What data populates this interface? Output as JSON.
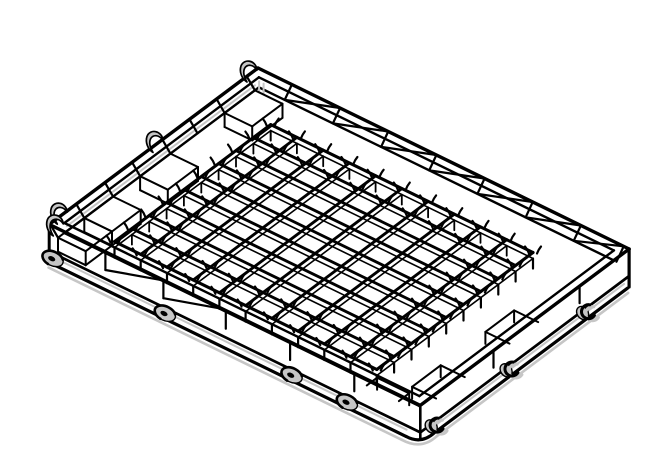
{
  "meta": {
    "type": "technical-line-drawing",
    "subject": "Isometric CAD line drawing of a rectangular wash-rack tray with waffle-grid bottom, perimeter rim, corner compartments, side mounting holes and wire retaining clips",
    "background": "#ffffff"
  },
  "drawing": {
    "canvas": {
      "width": 671,
      "height": 474
    },
    "colors": {
      "ink": "#000000",
      "shade": "#c6c6c6",
      "paper": "#ffffff"
    },
    "projection": {
      "origin": [
        258,
        68
      ],
      "axis_u": [
        0.892,
        0.435
      ],
      "axis_v": [
        -0.797,
        0.597
      ],
      "length_u": 416,
      "length_v": 262
    },
    "rim": {
      "inset": 9,
      "band_depth": 10,
      "stroke_outer": 3.4,
      "stroke_inner": 2.4
    },
    "grid": {
      "u_start": 50,
      "u_end": 344,
      "v_start": 40,
      "v_end": 236,
      "cols": 10,
      "rows": 9,
      "z_top": 11,
      "z_bottom": 17,
      "leg_bottom": 27,
      "bar_stroke": 2.9,
      "bottom_stroke": 1.6
    },
    "base": {
      "z_top": 27,
      "z_bottom": 38,
      "shadow_z": 40.5,
      "holes_u": [
        4,
        130,
        272,
        334
      ],
      "hooks_v": [
        242,
        148,
        52
      ]
    },
    "top_left_band": {
      "posts_v": [
        14,
        52,
        86,
        120,
        158,
        192,
        228,
        261
      ],
      "boxes_v": [
        [
          14,
          52
        ],
        [
          120,
          158
        ],
        [
          192,
          228
        ],
        [
          228,
          261
        ]
      ],
      "clips_v": [
        10,
        128,
        248
      ],
      "box_bottom_z": 24
    },
    "top_right_band": {
      "posts_u": [
        38,
        92,
        146,
        200,
        254,
        308,
        362,
        410
      ]
    },
    "front_left_wall": {
      "braced_posts_u": [
        55,
        120
      ],
      "plain_posts_u": [
        190,
        262,
        334
      ],
      "notches_u": [
        [
          348,
          384
        ]
      ],
      "corner_clip_u": 8,
      "brace_run": 62
    },
    "front_right_wall": {
      "posts_v": [
        52,
        160
      ],
      "notches_v": [
        [
          104,
          140
        ],
        [
          196,
          232
        ]
      ]
    },
    "notch": {
      "z_top": 15,
      "inset_depth": 27
    }
  }
}
